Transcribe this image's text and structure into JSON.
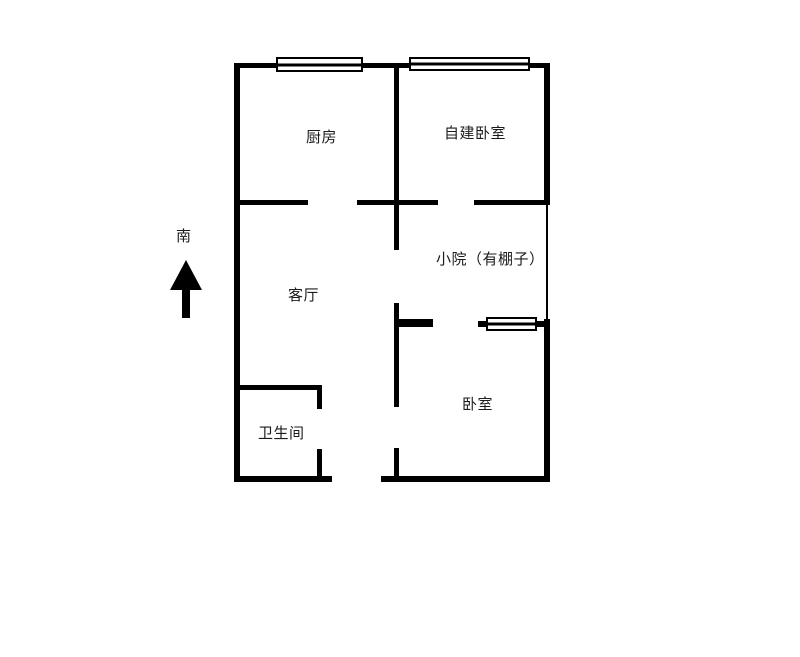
{
  "floor_plan": {
    "compass": {
      "label": "南",
      "arrow": "up-arrow"
    },
    "rooms": {
      "kitchen": {
        "label": "厨房"
      },
      "self_built_bedroom": {
        "label": "自建卧室"
      },
      "living_room": {
        "label": "客厅"
      },
      "yard": {
        "label": "小院（有棚子）"
      },
      "bedroom": {
        "label": "卧室"
      },
      "bathroom": {
        "label": "卫生间"
      }
    },
    "symbols": {
      "windows": [
        "kitchen-window",
        "self-built-bedroom-window",
        "bedroom-window"
      ]
    },
    "colors": {
      "wall": "#000000",
      "background": "#ffffff",
      "text": "#1c1c1c"
    }
  }
}
